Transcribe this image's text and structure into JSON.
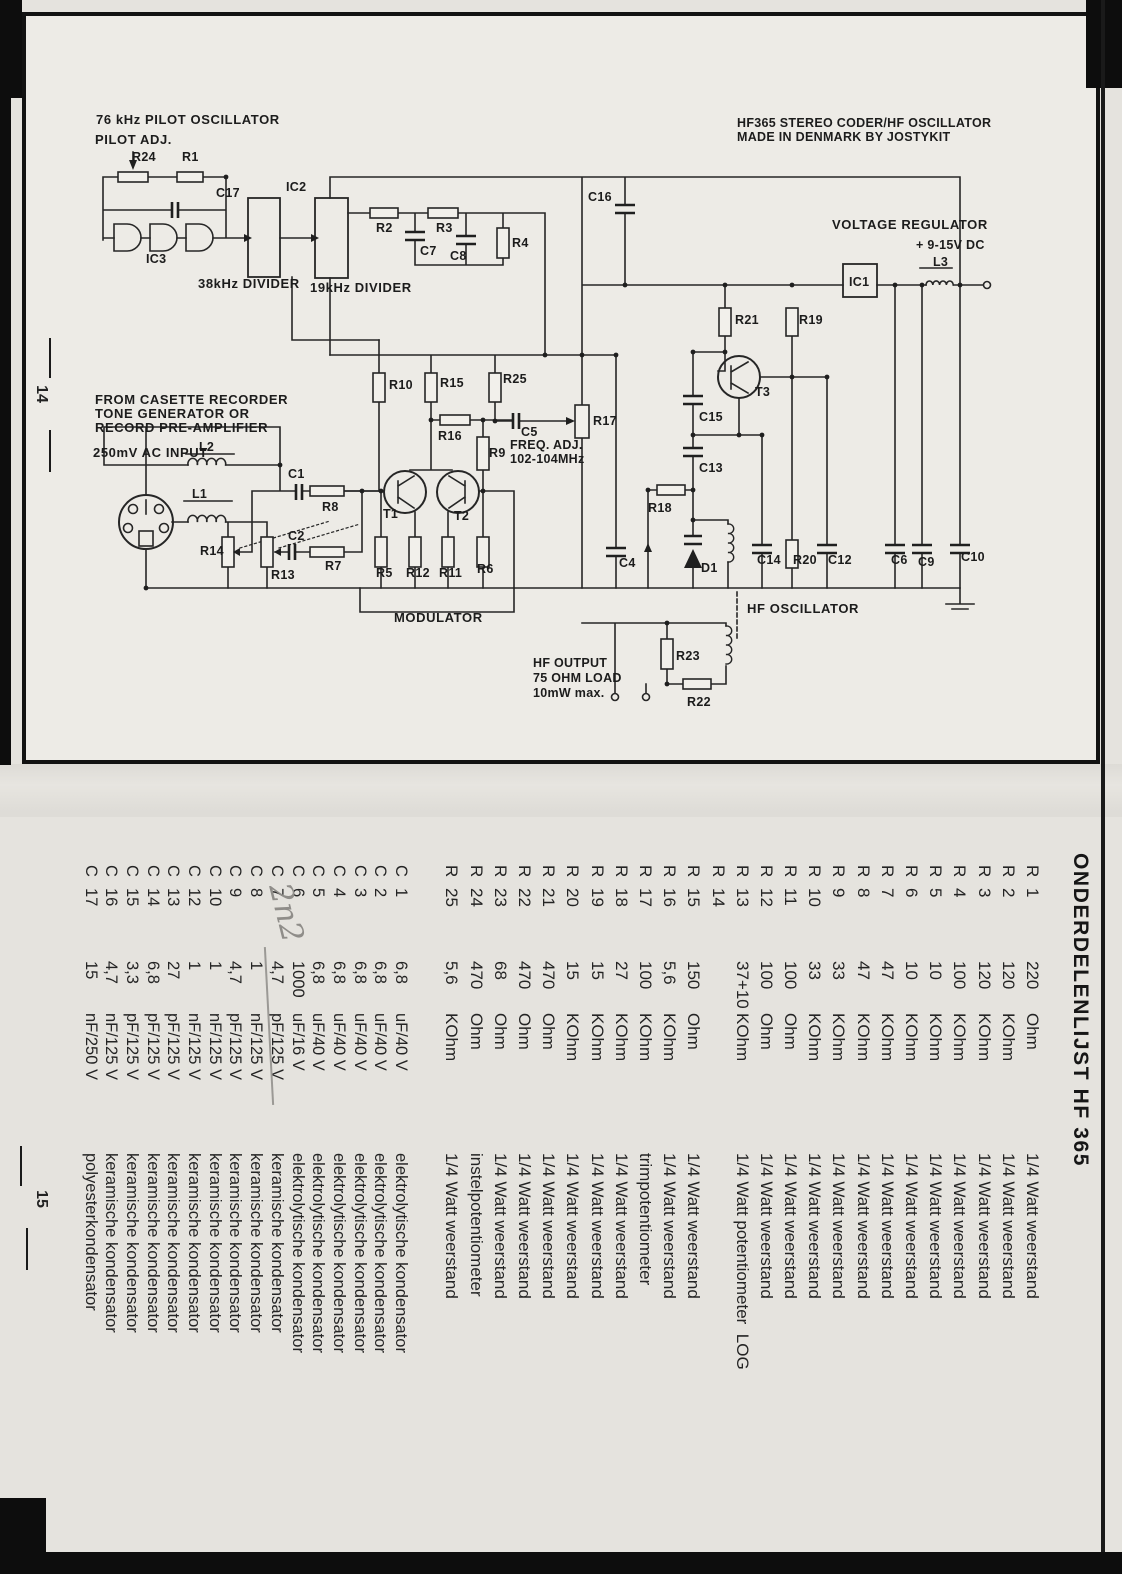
{
  "margins": {
    "top_page_number": "14",
    "bottom_page_number": "15"
  },
  "colors": {
    "paper": "#e9e7e2",
    "ink": "#1c1c1c",
    "pencil": "#8f8d89"
  },
  "schematic": {
    "labels": [
      {
        "t": "76 kHz PILOT OSCILLATOR",
        "x": 96,
        "y": 112,
        "c": "hdr"
      },
      {
        "t": "PILOT ADJ.",
        "x": 95,
        "y": 132,
        "c": "hdr"
      },
      {
        "t": "HF365   STEREO CODER/HF OSCILLATOR",
        "x": 737,
        "y": 116
      },
      {
        "t": "MADE IN DENMARK BY JOSTYKIT",
        "x": 737,
        "y": 130
      },
      {
        "t": "VOLTAGE REGULATOR",
        "x": 832,
        "y": 217,
        "c": "hdr"
      },
      {
        "t": "+  9-15V DC",
        "x": 916,
        "y": 238
      },
      {
        "t": "IC2",
        "x": 286,
        "y": 180
      },
      {
        "t": "R24",
        "x": 132,
        "y": 150
      },
      {
        "t": "R1",
        "x": 182,
        "y": 150
      },
      {
        "t": "C17",
        "x": 216,
        "y": 186
      },
      {
        "t": "IC3",
        "x": 146,
        "y": 252
      },
      {
        "t": "38kHz DIVIDER",
        "x": 198,
        "y": 276,
        "c": "hdr"
      },
      {
        "t": "19kHz DIVIDER",
        "x": 310,
        "y": 280,
        "c": "hdr"
      },
      {
        "t": "R2",
        "x": 376,
        "y": 221
      },
      {
        "t": "R3",
        "x": 436,
        "y": 221
      },
      {
        "t": "C7",
        "x": 420,
        "y": 244
      },
      {
        "t": "C8",
        "x": 450,
        "y": 249
      },
      {
        "t": "R4",
        "x": 512,
        "y": 236
      },
      {
        "t": "C16",
        "x": 588,
        "y": 190
      },
      {
        "t": "IC1",
        "x": 849,
        "y": 275
      },
      {
        "t": "L3",
        "x": 933,
        "y": 255
      },
      {
        "t": "R21",
        "x": 735,
        "y": 313
      },
      {
        "t": "R19",
        "x": 799,
        "y": 313
      },
      {
        "t": "T3",
        "x": 755,
        "y": 385
      },
      {
        "t": "C15",
        "x": 699,
        "y": 410
      },
      {
        "t": "C13",
        "x": 699,
        "y": 461
      },
      {
        "t": "R18",
        "x": 648,
        "y": 501
      },
      {
        "t": "D1",
        "x": 701,
        "y": 561
      },
      {
        "t": "C14",
        "x": 757,
        "y": 553
      },
      {
        "t": "R20",
        "x": 793,
        "y": 553
      },
      {
        "t": "C12",
        "x": 828,
        "y": 553
      },
      {
        "t": "C6",
        "x": 891,
        "y": 553
      },
      {
        "t": "C9",
        "x": 918,
        "y": 555
      },
      {
        "t": "C10",
        "x": 961,
        "y": 550
      },
      {
        "t": "R10",
        "x": 389,
        "y": 378
      },
      {
        "t": "R15",
        "x": 440,
        "y": 376
      },
      {
        "t": "R25",
        "x": 503,
        "y": 372
      },
      {
        "t": "R16",
        "x": 438,
        "y": 429
      },
      {
        "t": "C5",
        "x": 521,
        "y": 425
      },
      {
        "t": "R9",
        "x": 489,
        "y": 446
      },
      {
        "t": "FREQ. ADJ.",
        "x": 510,
        "y": 438
      },
      {
        "t": "102-104MHz",
        "x": 510,
        "y": 452
      },
      {
        "t": "R17",
        "x": 593,
        "y": 414
      },
      {
        "t": "T1",
        "x": 383,
        "y": 507
      },
      {
        "t": "T2",
        "x": 454,
        "y": 509
      },
      {
        "t": "R5",
        "x": 376,
        "y": 566
      },
      {
        "t": "R12",
        "x": 406,
        "y": 566
      },
      {
        "t": "R11",
        "x": 439,
        "y": 566
      },
      {
        "t": "R6",
        "x": 477,
        "y": 562
      },
      {
        "t": "C4",
        "x": 619,
        "y": 556
      },
      {
        "t": "C1",
        "x": 288,
        "y": 467
      },
      {
        "t": "R8",
        "x": 322,
        "y": 500
      },
      {
        "t": "C2",
        "x": 288,
        "y": 529
      },
      {
        "t": "R7",
        "x": 325,
        "y": 559
      },
      {
        "t": "R14",
        "x": 200,
        "y": 544
      },
      {
        "t": "R13",
        "x": 271,
        "y": 568
      },
      {
        "t": "L2",
        "x": 199,
        "y": 440
      },
      {
        "t": "L1",
        "x": 192,
        "y": 487
      },
      {
        "t": "250mV AC INPUT",
        "x": 93,
        "y": 445,
        "c": "hdr"
      },
      {
        "t": "FROM CASETTE RECORDER",
        "x": 95,
        "y": 392,
        "c": "hdr"
      },
      {
        "t": "TONE GENERATOR OR",
        "x": 95,
        "y": 406,
        "c": "hdr"
      },
      {
        "t": "RECORD PRE-AMPLIFIER",
        "x": 95,
        "y": 420,
        "c": "hdr"
      },
      {
        "t": "MODULATOR",
        "x": 394,
        "y": 610,
        "c": "hdr"
      },
      {
        "t": "HF OSCILLATOR",
        "x": 747,
        "y": 601,
        "c": "hdr"
      },
      {
        "t": "HF OUTPUT",
        "x": 533,
        "y": 656
      },
      {
        "t": "75 OHM LOAD",
        "x": 533,
        "y": 671
      },
      {
        "t": "10mW max.",
        "x": 533,
        "y": 686
      },
      {
        "t": "R23",
        "x": 676,
        "y": 649
      },
      {
        "t": "R22",
        "x": 687,
        "y": 695
      }
    ]
  },
  "parts_list": {
    "heading": "ONDERDELENLIJST HF 365",
    "annotation": "2n2",
    "resistors": [
      {
        "ref_l": "R",
        "ref_n": "1",
        "num": "220",
        "unit": "Ohm",
        "desc": "1/4 Watt weerstand"
      },
      {
        "ref_l": "R",
        "ref_n": "2",
        "num": "120",
        "unit": "KOhm",
        "desc": "1/4 Watt weerstand"
      },
      {
        "ref_l": "R",
        "ref_n": "3",
        "num": "120",
        "unit": "KOhm",
        "desc": "1/4 Watt weerstand"
      },
      {
        "ref_l": "R",
        "ref_n": "4",
        "num": "100",
        "unit": "KOhm",
        "desc": "1/4 Watt weerstand"
      },
      {
        "ref_l": "R",
        "ref_n": "5",
        "num": "10",
        "unit": "KOhm",
        "desc": "1/4 Watt weerstand"
      },
      {
        "ref_l": "R",
        "ref_n": "6",
        "num": "10",
        "unit": "KOhm",
        "desc": "1/4 Watt weerstand"
      },
      {
        "ref_l": "R",
        "ref_n": "7",
        "num": "47",
        "unit": "KOhm",
        "desc": "1/4 Watt weerstand"
      },
      {
        "ref_l": "R",
        "ref_n": "8",
        "num": "47",
        "unit": "KOhm",
        "desc": "1/4 Watt weerstand"
      },
      {
        "ref_l": "R",
        "ref_n": "9",
        "num": "33",
        "unit": "KOhm",
        "desc": "1/4 Watt weerstand"
      },
      {
        "ref_l": "R",
        "ref_n": "10",
        "num": "33",
        "unit": "KOhm",
        "desc": "1/4 Watt weerstand"
      },
      {
        "ref_l": "R",
        "ref_n": "11",
        "num": "100",
        "unit": "Ohm",
        "desc": "1/4 Watt weerstand"
      },
      {
        "ref_l": "R",
        "ref_n": "12",
        "num": "100",
        "unit": "Ohm",
        "desc": "1/4 Watt weerstand"
      },
      {
        "ref_l": "R",
        "ref_n": "13",
        "num": "37+10",
        "unit": "KOhm",
        "desc": "1/4 Watt potentiometer  LOG"
      },
      {
        "ref_l": "R",
        "ref_n": "14",
        "num": "",
        "unit": "",
        "desc": ""
      },
      {
        "ref_l": "R",
        "ref_n": "15",
        "num": "150",
        "unit": "Ohm",
        "desc": "1/4 Watt weerstand"
      },
      {
        "ref_l": "R",
        "ref_n": "16",
        "num": "5,6",
        "unit": "KOhm",
        "desc": "1/4 Watt weerstand"
      },
      {
        "ref_l": "R",
        "ref_n": "17",
        "num": "100",
        "unit": "KOhm",
        "desc": "trimpotentiometer"
      },
      {
        "ref_l": "R",
        "ref_n": "18",
        "num": "27",
        "unit": "KOhm",
        "desc": "1/4 Watt weerstand"
      },
      {
        "ref_l": "R",
        "ref_n": "19",
        "num": "15",
        "unit": "KOhm",
        "desc": "1/4 Watt weerstand"
      },
      {
        "ref_l": "R",
        "ref_n": "20",
        "num": "15",
        "unit": "KOhm",
        "desc": "1/4 Watt weerstand"
      },
      {
        "ref_l": "R",
        "ref_n": "21",
        "num": "470",
        "unit": "Ohm",
        "desc": "1/4 Watt weerstand"
      },
      {
        "ref_l": "R",
        "ref_n": "22",
        "num": "470",
        "unit": "Ohm",
        "desc": "1/4 Watt weerstand"
      },
      {
        "ref_l": "R",
        "ref_n": "23",
        "num": "68",
        "unit": "Ohm",
        "desc": "1/4 Watt weerstand"
      },
      {
        "ref_l": "R",
        "ref_n": "24",
        "num": "470",
        "unit": "Ohm",
        "desc": "instelpotentiometer"
      },
      {
        "ref_l": "R",
        "ref_n": "25",
        "num": "5,6",
        "unit": "KOhm",
        "desc": "1/4 Watt weerstand"
      }
    ],
    "capacitors": [
      {
        "ref_l": "C",
        "ref_n": "1",
        "num": "6,8",
        "unit": "uF/40 V",
        "desc": "elektrolytische kondensator"
      },
      {
        "ref_l": "C",
        "ref_n": "2",
        "num": "6,8",
        "unit": "uF/40 V",
        "desc": "elektrolytische kondensator"
      },
      {
        "ref_l": "C",
        "ref_n": "3",
        "num": "6,8",
        "unit": "uF/40 V",
        "desc": "elektrolytische kondensator"
      },
      {
        "ref_l": "C",
        "ref_n": "4",
        "num": "6,8",
        "unit": "uF/40 V",
        "desc": "elektrolytische kondensator"
      },
      {
        "ref_l": "C",
        "ref_n": "5",
        "num": "6,8",
        "unit": "uF/40 V",
        "desc": "elektrolytische kondensator"
      },
      {
        "ref_l": "C",
        "ref_n": "6",
        "num": "1000",
        "unit": "uF/16 V",
        "desc": "elektrolytische kondensator"
      },
      {
        "ref_l": "C",
        "ref_n": "7",
        "num": "4,7",
        "unit": "pF/125 V",
        "desc": "keramische kondensator"
      },
      {
        "ref_l": "C",
        "ref_n": "8",
        "num": "1",
        "unit": "nF/125 V",
        "desc": "keramische kondensator"
      },
      {
        "ref_l": "C",
        "ref_n": "9",
        "num": "4,7",
        "unit": "pF/125 V",
        "desc": "keramische kondensator"
      },
      {
        "ref_l": "C",
        "ref_n": "10",
        "num": "1",
        "unit": "nF/125 V",
        "desc": "keramische kondensator"
      },
      {
        "ref_l": "C",
        "ref_n": "12",
        "num": "1",
        "unit": "nF/125 V",
        "desc": "keramische kondensator"
      },
      {
        "ref_l": "C",
        "ref_n": "13",
        "num": "27",
        "unit": "pF/125 V",
        "desc": "keramische kondensator"
      },
      {
        "ref_l": "C",
        "ref_n": "14",
        "num": "6,8",
        "unit": "pF/125 V",
        "desc": "keramische kondensator"
      },
      {
        "ref_l": "C",
        "ref_n": "15",
        "num": "3,3",
        "unit": "pF/125 V",
        "desc": "keramische kondensator"
      },
      {
        "ref_l": "C",
        "ref_n": "16",
        "num": "4,7",
        "unit": "nF/125 V",
        "desc": "keramische kondensator"
      },
      {
        "ref_l": "C",
        "ref_n": "17",
        "num": "15",
        "unit": "nF/250 V",
        "desc": "polyesterkondensator"
      }
    ]
  }
}
